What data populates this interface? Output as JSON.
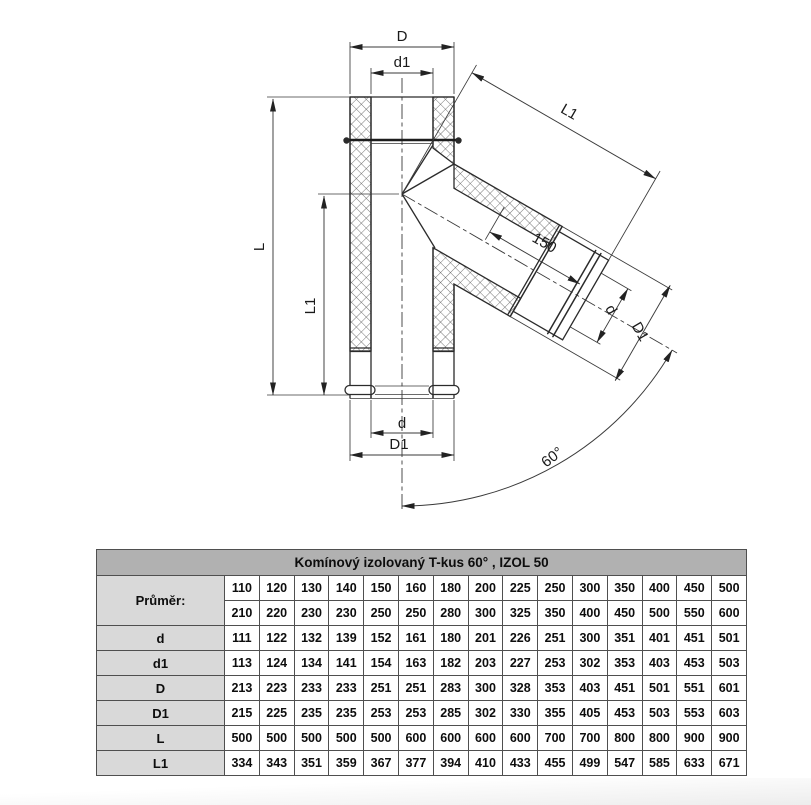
{
  "diagram": {
    "dim_D": "D",
    "dim_d1": "d1",
    "dim_L": "L",
    "dim_L1_left": "L1",
    "dim_L1_branch": "L1",
    "dim_150": "150",
    "dim_d_branch": "d",
    "dim_D1_branch": "D1",
    "dim_d_bottom": "d",
    "dim_D1_bottom": "D1",
    "dim_angle": "60°"
  },
  "table": {
    "title": "Komínový izolovaný T-kus 60° , IZOL 50",
    "diameter_label": "Průměr:",
    "diameter_rows": [
      [
        "110",
        "120",
        "130",
        "140",
        "150",
        "160",
        "180",
        "200",
        "225",
        "250",
        "300",
        "350",
        "400",
        "450",
        "500"
      ],
      [
        "210",
        "220",
        "230",
        "230",
        "250",
        "250",
        "280",
        "300",
        "325",
        "350",
        "400",
        "450",
        "500",
        "550",
        "600"
      ]
    ],
    "rows": [
      {
        "label": "d",
        "values": [
          "111",
          "122",
          "132",
          "139",
          "152",
          "161",
          "180",
          "201",
          "226",
          "251",
          "300",
          "351",
          "401",
          "451",
          "501"
        ]
      },
      {
        "label": "d1",
        "values": [
          "113",
          "124",
          "134",
          "141",
          "154",
          "163",
          "182",
          "203",
          "227",
          "253",
          "302",
          "353",
          "403",
          "453",
          "503"
        ]
      },
      {
        "label": "D",
        "values": [
          "213",
          "223",
          "233",
          "233",
          "251",
          "251",
          "283",
          "300",
          "328",
          "353",
          "403",
          "451",
          "501",
          "551",
          "601"
        ]
      },
      {
        "label": "D1",
        "values": [
          "215",
          "225",
          "235",
          "235",
          "253",
          "253",
          "285",
          "302",
          "330",
          "355",
          "405",
          "453",
          "503",
          "553",
          "603"
        ]
      },
      {
        "label": "L",
        "values": [
          "500",
          "500",
          "500",
          "500",
          "500",
          "600",
          "600",
          "600",
          "600",
          "700",
          "700",
          "800",
          "800",
          "900",
          "900"
        ]
      },
      {
        "label": "L1",
        "values": [
          "334",
          "343",
          "351",
          "359",
          "367",
          "377",
          "394",
          "410",
          "433",
          "455",
          "499",
          "547",
          "585",
          "633",
          "671"
        ]
      }
    ]
  },
  "colors": {
    "header_bg": "#b1b1b1",
    "label_bg": "#d9d9d9",
    "border": "#4f4f4f",
    "line": "#2b2b2b"
  }
}
